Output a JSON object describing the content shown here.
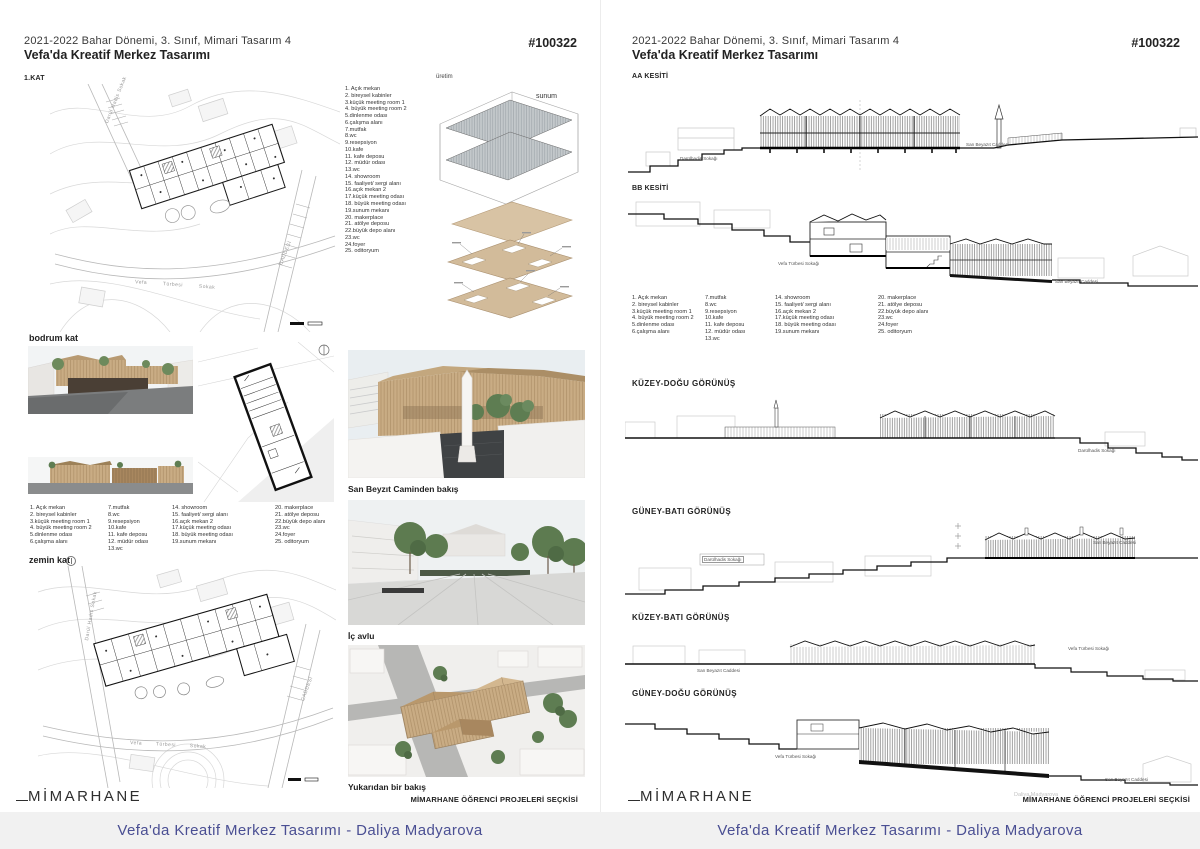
{
  "header": {
    "line1": "2021-2022 Bahar Dönemi, 3. Sınıf, Mimari Tasarım 4",
    "line2": "Vefa'da Kreatif Merkez Tasarımı",
    "code": "#100322"
  },
  "left": {
    "floor1_label": "1.KAT",
    "basement_label": "bodrum kat",
    "ground_label": "zemin kat",
    "axo": {
      "top": "üretim",
      "right": "sunum"
    },
    "captions": {
      "r1": "San Beyzıt Caminden bakış",
      "r2": "İç avlu",
      "r3": "Yukarıdan bir bakış"
    }
  },
  "right": {
    "section_aa_label": "AA KESİTİ",
    "section_bb_label": "BB KESİTİ",
    "elev_ne_label": "KÜZEY-DOĞU GÖRÜNÜŞ",
    "elev_sw_label": "GÜNEY-BATI GÖRÜNÜŞ",
    "elev_nw_label": "KÜZEY-BATI GÖRÜNÜŞ",
    "elev_se_label": "GÜNEY-DOĞU GÖRÜNÜŞ",
    "watermark": "Daliya Madyarova"
  },
  "streets": {
    "darulhadis": "Darülhadis Sokağı",
    "sanbeyazit": "San Beyazıt Caddesi",
    "vefaturbesi": "Vefa Türbesi Sokağı",
    "plan_darulhadis": "Darül Hadis Sokak",
    "plan_vefaturbesi": "Vefa Türbesi Sokak",
    "plan_caddesi": "CADDESİ"
  },
  "legend": {
    "col1": [
      "1. Açık mekan",
      "2. bireysel kabinler",
      "3.küçük meeting room 1",
      "4. büyük meeting room 2",
      "5.dinlenme odası",
      "6.çalışma alanı"
    ],
    "col2": [
      "7.mutfak",
      "8.wc",
      "9.resepsiyon",
      "10.kafe",
      "11. kafe deposu",
      "12. müdür odası",
      "13.wc"
    ],
    "col3": [
      "14. showroom",
      "15. faaliyet/ sergi alanı",
      "16.açık mekan 2",
      "17.küçük meeting odası",
      "18. büyük meeting odası",
      "19.sunum mekanı"
    ],
    "col4": [
      "20. makerplace",
      "21. atölye deposu",
      "22.büyük depo alanı",
      "23.wc",
      "24.foyer",
      "25. oditoryum"
    ]
  },
  "footer": {
    "logo": "MİMARHANE",
    "selection": "MİMARHANE ÖĞRENCİ PROJELERİ SEÇKİSİ"
  },
  "banner": {
    "text": "Vefa'da Kreatif Merkez Tasarımı - Daliya Madyarova",
    "color": "#4a4f93"
  }
}
